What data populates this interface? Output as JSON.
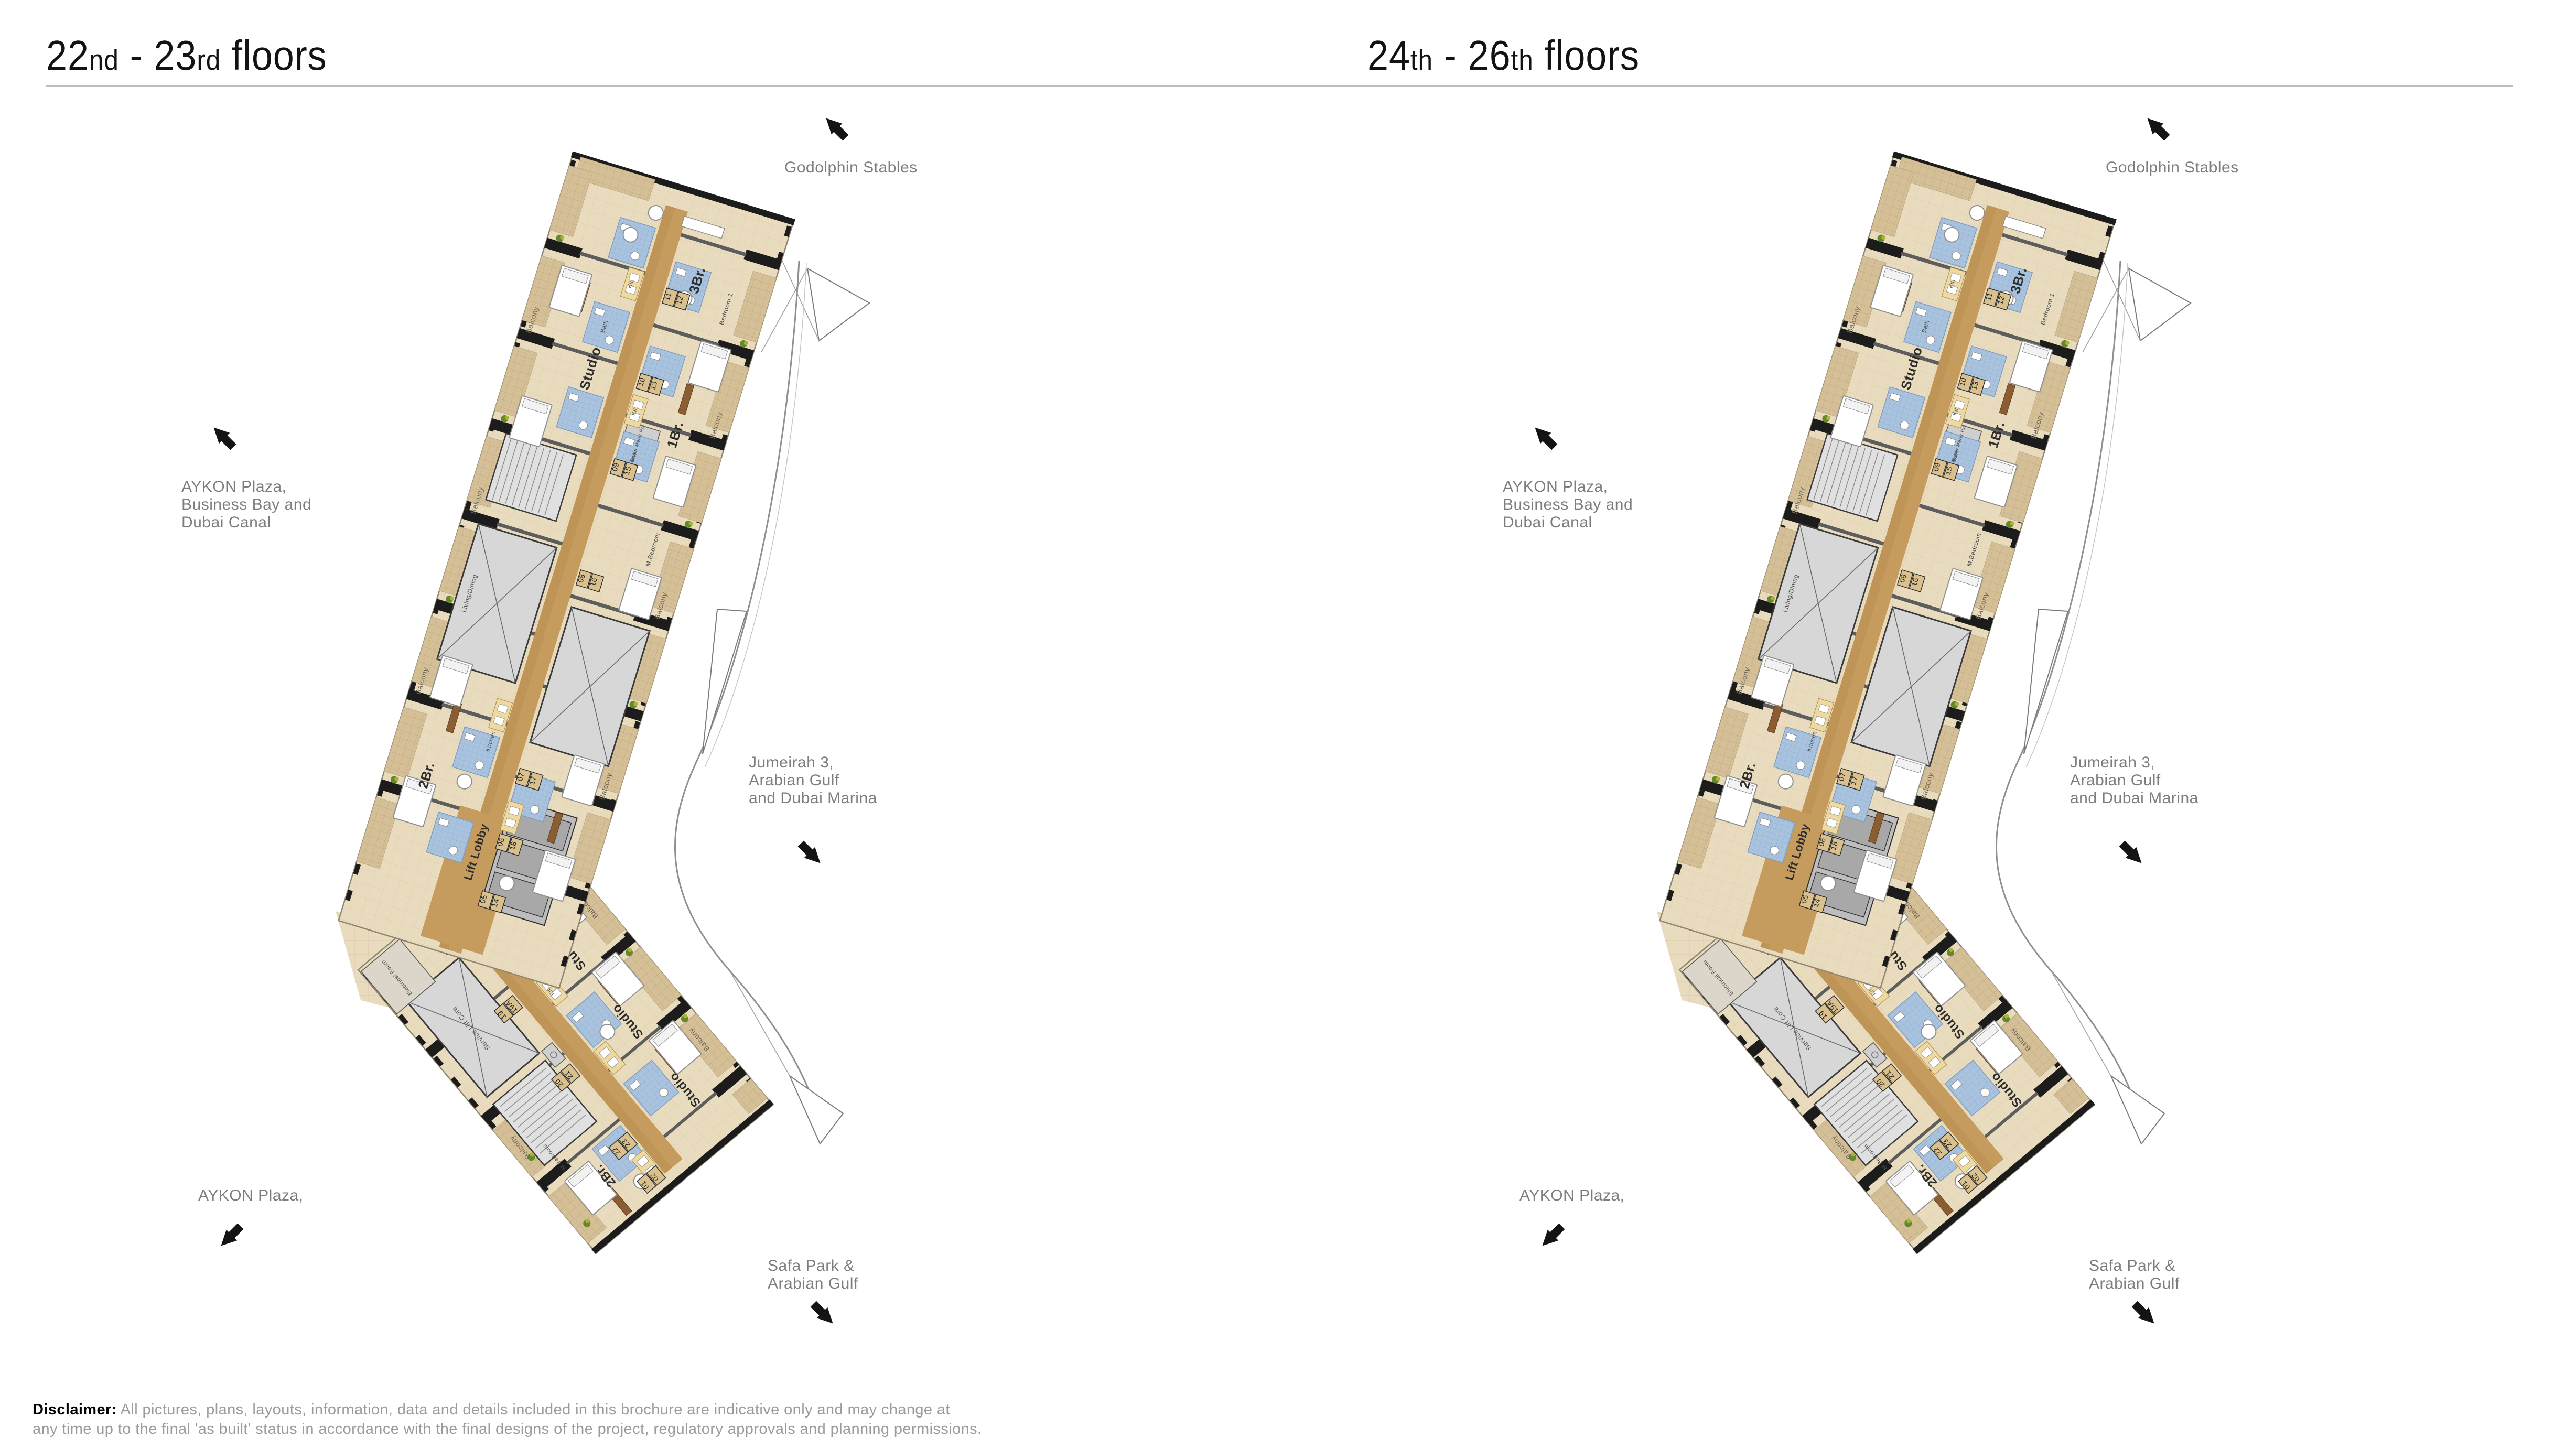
{
  "page": {
    "background": "#ffffff",
    "rule_color": "#bcbcbc"
  },
  "panels": [
    {
      "name": "22nd-23rd floors",
      "title": {
        "b1": "22",
        "s1": "nd",
        "b2": " - 23",
        "s2": "rd",
        "b3": " floors"
      }
    },
    {
      "name": "24th-26th floors",
      "title": {
        "b1": "24",
        "s1": "th",
        "b2": " - 26",
        "s2": "th",
        "b3": " floors"
      }
    }
  ],
  "direction_labels": {
    "godolphin": "Godolphin Stables",
    "aykon_plaza_business_bay": [
      "AYKON Plaza,",
      "Business Bay and",
      "Dubai Canal"
    ],
    "jumeirah": [
      "Jumeirah 3,",
      "Arabian Gulf",
      "and Dubai Marina"
    ],
    "aykon_plaza": "AYKON Plaza,",
    "safa_park": [
      "Safa Park &",
      "Arabian Gulf"
    ]
  },
  "disclaimer": {
    "label": "Disclaimer:",
    "line1": "All pictures, plans, layouts, information, data and details included in this brochure are indicative only and may change at",
    "line2": "any time up to the final 'as built' status in accordance with the final designs of the project, regulatory approvals and planning permissions."
  },
  "plan": {
    "room_labels": {
      "lift_lobby": "Lift Lobby",
      "service_lift_core": "Service Lift Core",
      "studio": "Studio",
      "one_br": "1Br.",
      "two_br": "2Br.",
      "three_br": "3Br.",
      "balcony": "Balcony",
      "bath": "Bath",
      "kit": "Kit.",
      "kitchen": "Kitchen",
      "living_dining": "Living/Dining",
      "m_bedroom": "M.Bedroom",
      "bedroom1": "Bedroom 1",
      "bedroom2": "Bedroom 2",
      "water_meter": "Water Meter Rm",
      "garbage_chute": "Garbage Chute",
      "electrical": "Electrical Room"
    },
    "unit_numbers_top": [
      [
        "11",
        "12"
      ],
      [
        "10",
        "13"
      ],
      [
        "09",
        "15"
      ],
      [
        "08",
        "16"
      ],
      [
        "07",
        "17"
      ],
      [
        "06",
        "18"
      ],
      [
        "05",
        "14"
      ]
    ],
    "unit_numbers_bottom": [
      [
        "04",
        "03"
      ],
      [
        "19",
        "19A"
      ],
      [
        "20",
        "21"
      ],
      [
        "22",
        "23"
      ],
      [
        "01",
        "02"
      ]
    ],
    "colors": {
      "room": "#e9dcbe",
      "room_grid": "#ddcdaa",
      "balcony": "#d4bf97",
      "balcony_grid": "#bfaa81",
      "corridor": "#c59c5e",
      "corridor_dark": "#b78d4f",
      "bath": "#a9c3df",
      "bath_grid": "#8fafd0",
      "core": "#d7d7d7",
      "stair": "#e0e0e0",
      "wall": "#1c1c1c",
      "wall_mid": "#5d5d5d",
      "wood": "#8b5d32",
      "kitchen": "#eed9a1",
      "plant_dark": "#66882c",
      "plant_light": "#a9b52f",
      "outline": "#8f856f",
      "fin": "#8f8f8f",
      "furniture": "#8f8f8f"
    }
  }
}
